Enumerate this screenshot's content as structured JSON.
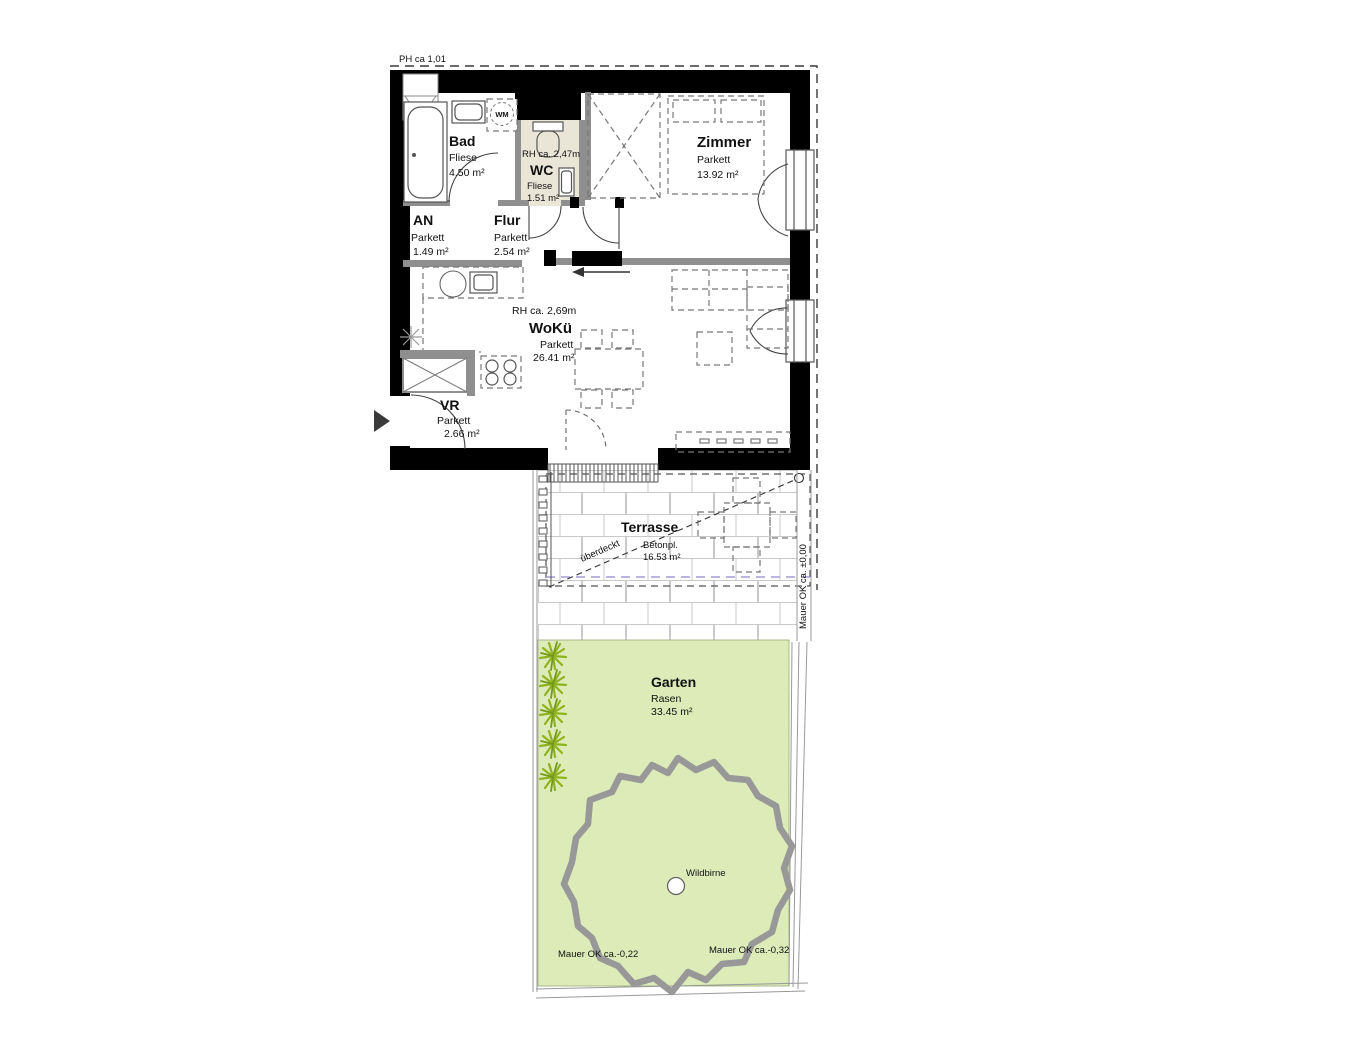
{
  "plan": {
    "ph": "PH ca 1,01",
    "rooms": {
      "bad": {
        "name": "Bad",
        "floor": "Fliese",
        "area": "4.50 m²"
      },
      "wc": {
        "rh": "RH ca. 2,47m",
        "name": "WC",
        "floor": "Fliese",
        "area": "1.51 m²"
      },
      "zimmer": {
        "name": "Zimmer",
        "floor": "Parkett",
        "area": "13.92 m²"
      },
      "an": {
        "name": "AN",
        "floor": "Parkett",
        "area": "1.49 m²"
      },
      "flur": {
        "name": "Flur",
        "floor": "Parkett",
        "area": "2.54 m²"
      },
      "woku": {
        "rh": "RH ca. 2,69m",
        "name": "WoKü",
        "floor": "Parkett",
        "area": "26.41 m²"
      },
      "vr": {
        "name": "VR",
        "floor": "Parkett",
        "area": "2.66 m²"
      }
    },
    "appliances": {
      "wm": "WM"
    },
    "terrasse": {
      "name": "Terrasse",
      "floor": "Betonpl.",
      "area": "16.53 m²",
      "covered": "überdeckt",
      "wall": "Mauer OK ca. ±0,00"
    },
    "garten": {
      "name": "Garten",
      "floor": "Rasen",
      "area": "33.45 m²",
      "tree": "Wildbirne",
      "wall_left": "Mauer OK ca.-0,22",
      "wall_right": "Mauer OK ca.-0,32"
    }
  },
  "colors": {
    "wall": "#000000",
    "gwall": "#8f8f8f",
    "wcfloor": "#eae6d7",
    "garden": "#dcebb8",
    "shrub": "#8fb21f",
    "shrubdark": "#74991a",
    "tree": "#989898",
    "brick": "#c9c9c9",
    "covered": "#a39bd4",
    "ink": "#111111"
  }
}
